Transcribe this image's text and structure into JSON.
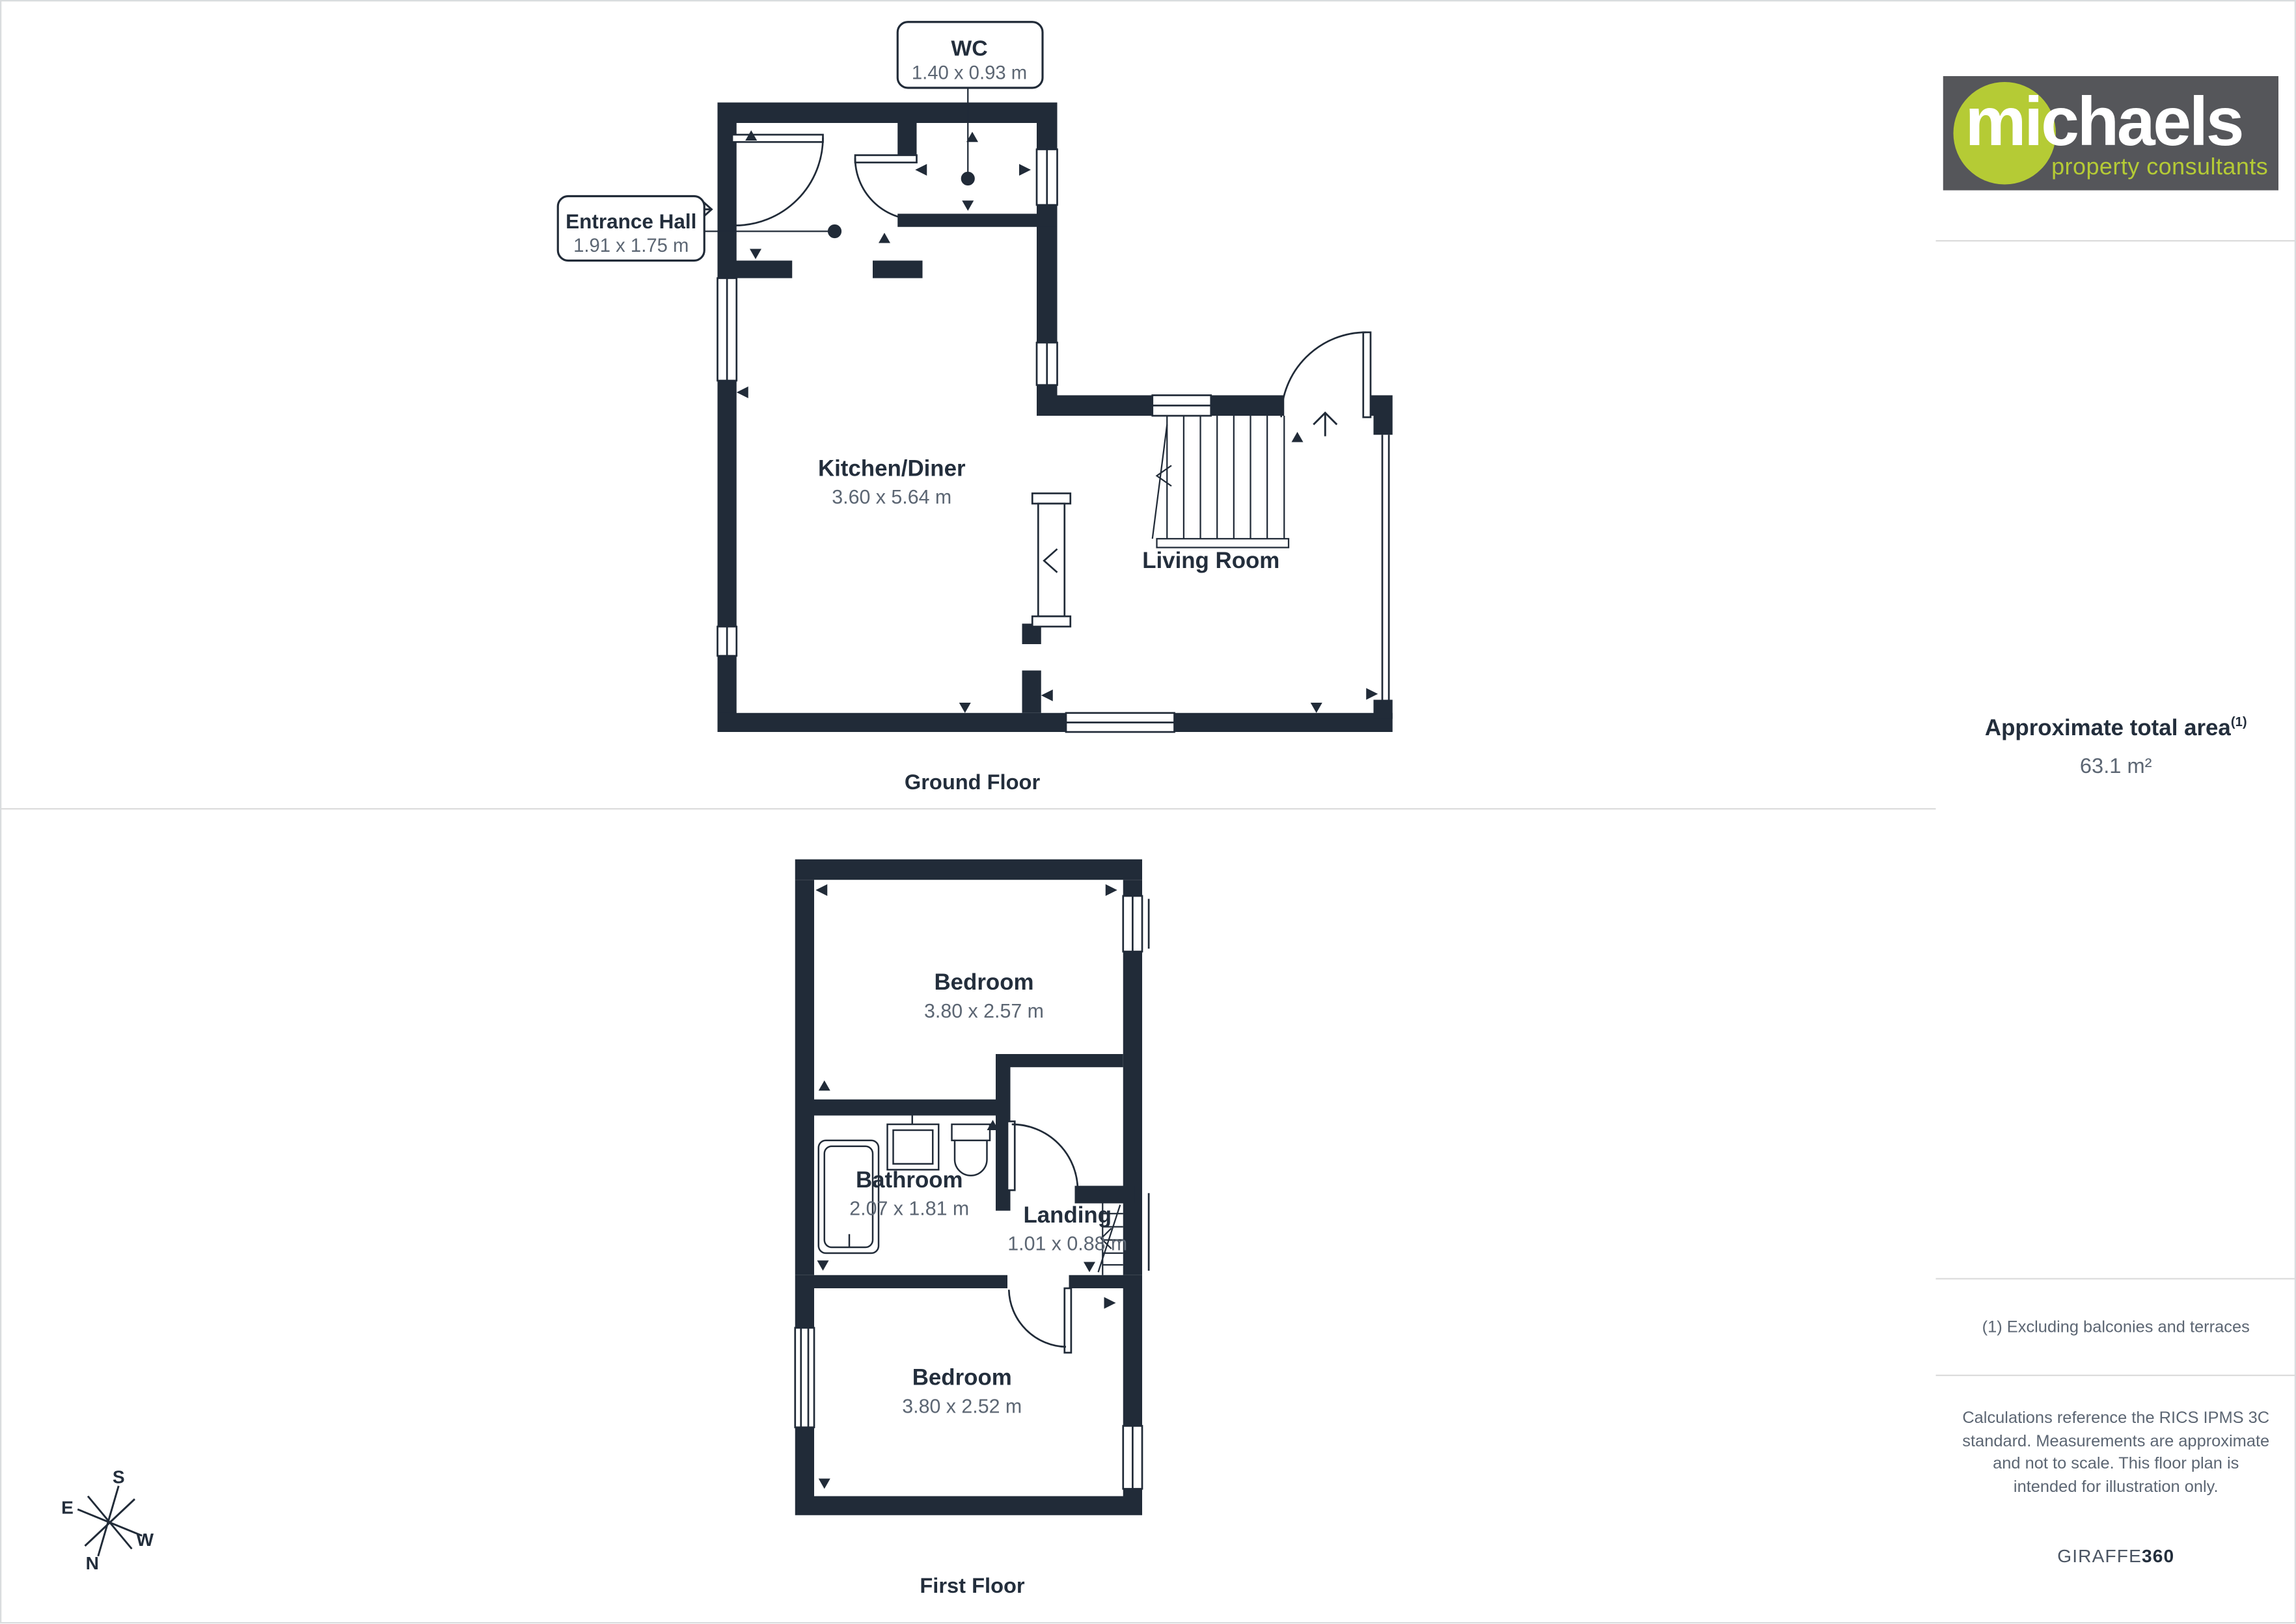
{
  "ground_floor": {
    "label": "Ground Floor",
    "rooms": {
      "wc": {
        "name": "WC",
        "dims": "1.40 x 0.93 m"
      },
      "entrance_hall": {
        "name": "Entrance Hall",
        "dims": "1.91 x 1.75 m"
      },
      "kitchen_diner": {
        "name": "Kitchen/Diner",
        "dims": "3.60 x 5.64 m"
      },
      "living_room": {
        "name": "Living Room"
      }
    }
  },
  "first_floor": {
    "label": "First Floor",
    "rooms": {
      "bedroom_front": {
        "name": "Bedroom",
        "dims": "3.80 x 2.57 m"
      },
      "bathroom": {
        "name": "Bathroom",
        "dims": "2.07 x 1.81 m"
      },
      "landing": {
        "name": "Landing",
        "dims": "1.01 x 0.88 m"
      },
      "bedroom_back": {
        "name": "Bedroom",
        "dims": "3.80 x 2.52 m"
      }
    }
  },
  "compass": {
    "n": "N",
    "e": "E",
    "s": "S",
    "w": "W"
  },
  "sidebar": {
    "logo": {
      "brand": "michaels",
      "tagline": "property consultants"
    },
    "area": {
      "title": "Approximate total area",
      "superscript": "(1)",
      "value": "63.1 m²"
    },
    "footnote": "(1) Excluding balconies and terraces",
    "disclaimer": "Calculations reference the RICS IPMS 3C standard. Measurements are approximate and not to scale. This floor plan is intended for illustration only.",
    "credit": {
      "brand": "GIRAFFE",
      "suffix": "360"
    }
  },
  "colors": {
    "wall": "#212b38",
    "room_label": "#232e3c",
    "dim_text": "#5c6673",
    "accent_green": "#b5cb35",
    "logo_bg": "#55565a",
    "divider": "#dcdcdc",
    "frame": "#d9dcde"
  }
}
